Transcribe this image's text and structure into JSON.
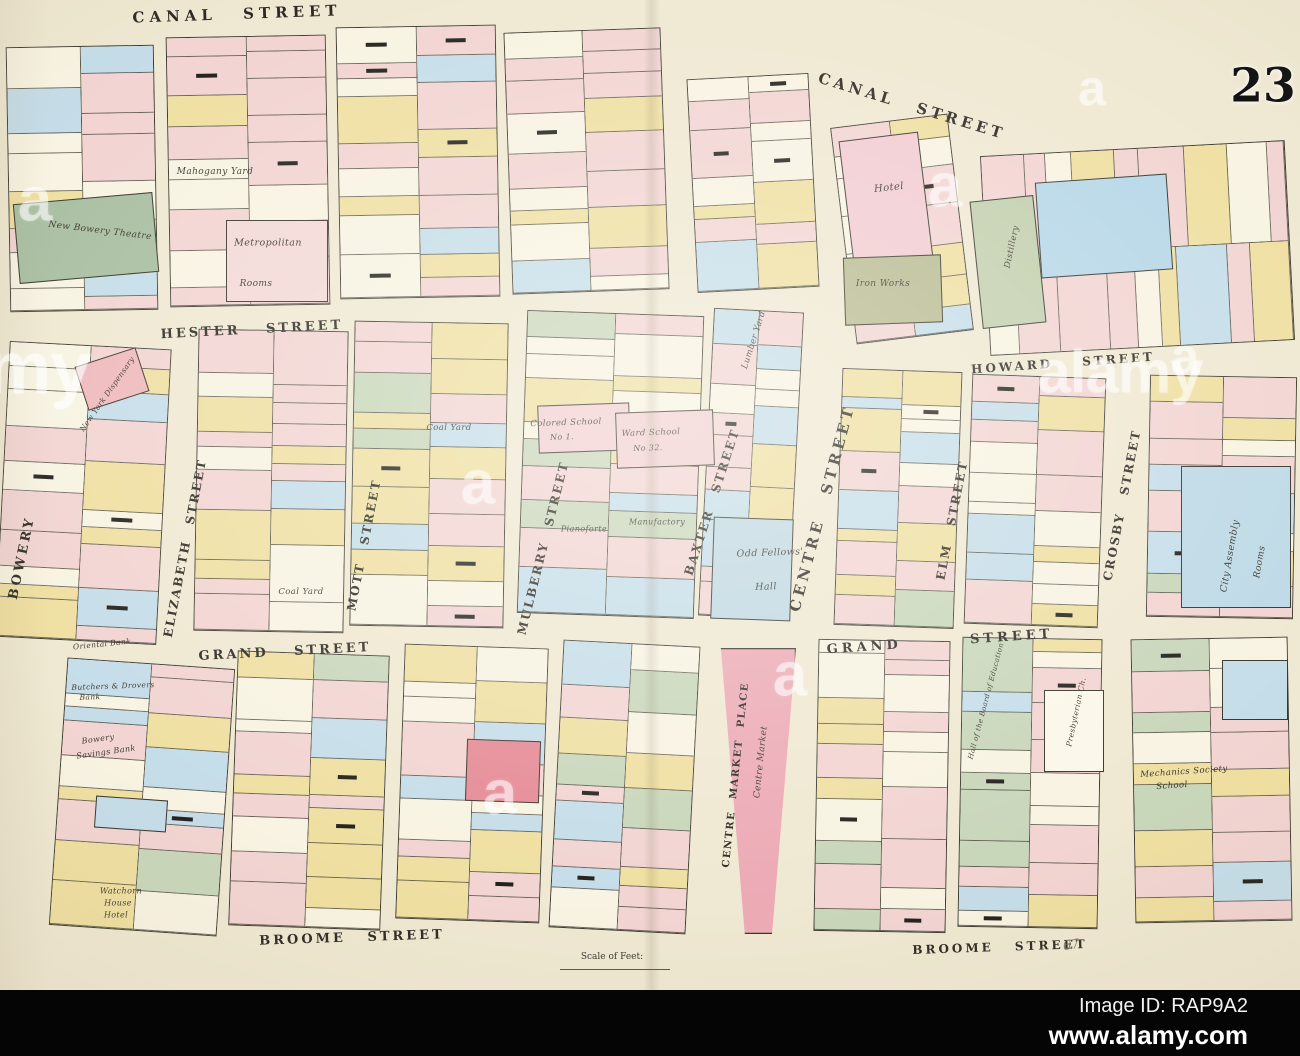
{
  "page": {
    "plate_number": "23"
  },
  "watermark": {
    "brand": "alamy",
    "tile_letter": "a",
    "image_id_label": "Image ID: RAP9A2",
    "url": "www.alamy.com",
    "tiles": [
      {
        "x": 35,
        "y": 200,
        "s": 62
      },
      {
        "x": 478,
        "y": 483,
        "s": 62
      },
      {
        "x": 500,
        "y": 793,
        "s": 62
      },
      {
        "x": 790,
        "y": 675,
        "s": 62
      },
      {
        "x": 945,
        "y": 186,
        "s": 62
      },
      {
        "x": 1092,
        "y": 88,
        "s": 50
      },
      {
        "x": 1185,
        "y": 357,
        "s": 52
      }
    ],
    "words": [
      {
        "x": -12,
        "y": 368,
        "s": 74
      },
      {
        "x": 1120,
        "y": 372,
        "s": 60
      }
    ]
  },
  "map": {
    "scale_label": "Scale of Feet:",
    "pencil_note": "67",
    "paper_color": "#efe8d2",
    "palette": {
      "pink": "#f2d4d2",
      "cream": "#f8f3e2",
      "yellow": "#efdfa1",
      "blue": "#c5dde9",
      "green": "#c8d6ba"
    },
    "street_labels": [
      {
        "text": "CANAL STREET",
        "x": 237,
        "y": 14,
        "r": -2,
        "s": 15,
        "ls": 5,
        "ws": 16
      },
      {
        "text": "CANAL STREET",
        "x": 912,
        "y": 106,
        "r": 17,
        "s": 15,
        "ls": 4,
        "ws": 14
      },
      {
        "text": "HESTER STREET",
        "x": 252,
        "y": 330,
        "r": -3,
        "s": 13,
        "ls": 3,
        "ws": 18
      },
      {
        "text": "HOWARD STREET",
        "x": 1063,
        "y": 363,
        "r": -4,
        "s": 12,
        "ls": 3,
        "ws": 22
      },
      {
        "text": "GRAND STREET",
        "x": 285,
        "y": 652,
        "r": -3,
        "s": 13,
        "ls": 3,
        "ws": 18
      },
      {
        "text": "GRAND STREET",
        "x": 940,
        "y": 642,
        "r": -4,
        "s": 13,
        "ls": 4,
        "ws": 60
      },
      {
        "text": "BROOME STREET",
        "x": 352,
        "y": 938,
        "r": -2,
        "s": 13,
        "ls": 3,
        "ws": 14
      },
      {
        "text": "BROOME STREET",
        "x": 1000,
        "y": 947,
        "r": -2,
        "s": 12,
        "ls": 3,
        "ws": 14
      },
      {
        "text": "BOWERY",
        "x": 22,
        "y": 558,
        "r": -78,
        "s": 13,
        "ls": 3,
        "ws": 8
      },
      {
        "text": "ELIZABETH STREET",
        "x": 185,
        "y": 548,
        "r": -79,
        "s": 12,
        "ls": 2,
        "ws": 10
      },
      {
        "text": "MOTT STREET",
        "x": 364,
        "y": 545,
        "r": -79,
        "s": 12,
        "ls": 2,
        "ws": 12
      },
      {
        "text": "MULBERRY STREET",
        "x": 543,
        "y": 548,
        "r": -76,
        "s": 12,
        "ls": 2,
        "ws": 10
      },
      {
        "text": "BAXTER STREET",
        "x": 712,
        "y": 502,
        "r": -72,
        "s": 12,
        "ls": 2,
        "ws": 12
      },
      {
        "text": "CENTRE STREET",
        "x": 822,
        "y": 508,
        "r": -75,
        "s": 15,
        "ls": 4,
        "ws": 16
      },
      {
        "text": "ELM STREET",
        "x": 952,
        "y": 520,
        "r": -79,
        "s": 12,
        "ls": 2,
        "ws": 12
      },
      {
        "text": "CROSBY STREET",
        "x": 1122,
        "y": 505,
        "r": -79,
        "s": 12,
        "ls": 2,
        "ws": 12
      },
      {
        "text": "CENTRE MARKET PLACE",
        "x": 736,
        "y": 775,
        "r": -84,
        "s": 10,
        "ls": 1.5,
        "ws": 7
      }
    ],
    "building_labels": [
      {
        "text": "Mahogany Yard",
        "x": 215,
        "y": 172,
        "r": 0,
        "s": 9
      },
      {
        "text": "Metropolitan",
        "x": 268,
        "y": 243,
        "r": 0,
        "s": 9.5
      },
      {
        "text": "Rooms",
        "x": 256,
        "y": 284,
        "r": 0,
        "s": 9
      },
      {
        "text": "New Bowery Theatre",
        "x": 100,
        "y": 231,
        "r": 7,
        "s": 9
      },
      {
        "text": "New York Dispensary",
        "x": 107,
        "y": 394,
        "r": -55,
        "s": 7.5
      },
      {
        "text": "Hotel",
        "x": 889,
        "y": 188,
        "r": -6,
        "s": 10
      },
      {
        "text": "Iron Works",
        "x": 883,
        "y": 284,
        "r": 0,
        "s": 9
      },
      {
        "text": "Distillery",
        "x": 1012,
        "y": 247,
        "r": -78,
        "s": 8.5
      },
      {
        "text": "Coal Yard",
        "x": 449,
        "y": 428,
        "r": 0,
        "s": 8.5
      },
      {
        "text": "Colored School",
        "x": 566,
        "y": 423,
        "r": -2,
        "s": 8.5
      },
      {
        "text": "No 1.",
        "x": 562,
        "y": 437,
        "r": -2,
        "s": 8
      },
      {
        "text": "Ward School",
        "x": 651,
        "y": 433,
        "r": -2,
        "s": 8.5
      },
      {
        "text": "No 32.",
        "x": 648,
        "y": 448,
        "r": -2,
        "s": 8
      },
      {
        "text": "Lumber Yard",
        "x": 754,
        "y": 340,
        "r": -72,
        "s": 8.5
      },
      {
        "text": "Pianoforte",
        "x": 584,
        "y": 529,
        "r": 0,
        "s": 8
      },
      {
        "text": "Manufactory",
        "x": 657,
        "y": 522,
        "r": 0,
        "s": 8
      },
      {
        "text": "Odd Fellows'",
        "x": 770,
        "y": 553,
        "r": -2,
        "s": 9.5
      },
      {
        "text": "Hall",
        "x": 766,
        "y": 587,
        "r": -2,
        "s": 9.5
      },
      {
        "text": "City Assembly",
        "x": 1230,
        "y": 556,
        "r": -80,
        "s": 9.5
      },
      {
        "text": "Rooms",
        "x": 1260,
        "y": 562,
        "r": -80,
        "s": 9
      },
      {
        "text": "Coal Yard",
        "x": 301,
        "y": 592,
        "r": 0,
        "s": 8.5
      },
      {
        "text": "Oriental Bank",
        "x": 102,
        "y": 644,
        "r": -6,
        "s": 7.5
      },
      {
        "text": "Butchers & Drovers",
        "x": 113,
        "y": 686,
        "r": -2,
        "s": 7.5
      },
      {
        "text": "Bank",
        "x": 90,
        "y": 697,
        "r": -2,
        "s": 7.5
      },
      {
        "text": "Bowery",
        "x": 98,
        "y": 739,
        "r": -8,
        "s": 8
      },
      {
        "text": "Savings Bank",
        "x": 106,
        "y": 752,
        "r": -8,
        "s": 8
      },
      {
        "text": "Watchorn",
        "x": 121,
        "y": 891,
        "r": 0,
        "s": 8
      },
      {
        "text": "House",
        "x": 118,
        "y": 903,
        "r": 0,
        "s": 8
      },
      {
        "text": "Hotel",
        "x": 116,
        "y": 915,
        "r": 0,
        "s": 8
      },
      {
        "text": "Hall of the Board of Education",
        "x": 986,
        "y": 701,
        "r": -75,
        "s": 7
      },
      {
        "text": "Presbyterian Ch.",
        "x": 1076,
        "y": 712,
        "r": -78,
        "s": 7.5
      },
      {
        "text": "Centre Market",
        "x": 761,
        "y": 762,
        "r": -84,
        "s": 9
      },
      {
        "text": "Mechanics Society",
        "x": 1184,
        "y": 772,
        "r": -4,
        "s": 8.5
      },
      {
        "text": "School",
        "x": 1172,
        "y": 786,
        "r": -4,
        "s": 8.5
      }
    ],
    "blocks": [
      {
        "x": 8,
        "y": 46,
        "w": 148,
        "h": 265,
        "r": -1,
        "dir": "v",
        "n": 8,
        "seed": 11
      },
      {
        "x": 168,
        "y": 36,
        "w": 160,
        "h": 270,
        "r": -1,
        "dir": "v",
        "n": 9,
        "seed": 12
      },
      {
        "x": 338,
        "y": 26,
        "w": 160,
        "h": 272,
        "r": -1,
        "dir": "v",
        "n": 9,
        "seed": 13
      },
      {
        "x": 508,
        "y": 30,
        "w": 157,
        "h": 262,
        "r": -2,
        "dir": "v",
        "n": 9,
        "seed": 14
      },
      {
        "x": 692,
        "y": 76,
        "w": 122,
        "h": 214,
        "r": -3,
        "dir": "v",
        "n": 7,
        "seed": 15
      },
      {
        "x": 843,
        "y": 120,
        "w": 118,
        "h": 218,
        "r": -7,
        "dir": "v",
        "n": 7,
        "seed": 16
      },
      {
        "x": 985,
        "y": 148,
        "w": 305,
        "h": 200,
        "r": -3,
        "dir": "h",
        "n": 9,
        "seed": 17
      },
      {
        "x": 2,
        "y": 345,
        "w": 162,
        "h": 296,
        "r": 3,
        "dir": "v",
        "n": 10,
        "seed": 21
      },
      {
        "x": 196,
        "y": 330,
        "w": 150,
        "h": 302,
        "r": 1,
        "dir": "v",
        "n": 10,
        "seed": 22
      },
      {
        "x": 352,
        "y": 322,
        "w": 154,
        "h": 305,
        "r": 1,
        "dir": "v",
        "n": 10,
        "seed": 23
      },
      {
        "x": 522,
        "y": 313,
        "w": 177,
        "h": 303,
        "r": 2,
        "dir": "v",
        "n": 10,
        "seed": 24
      },
      {
        "x": 706,
        "y": 310,
        "w": 90,
        "h": 308,
        "r": 3,
        "dir": "v",
        "n": 10,
        "seed": 25
      },
      {
        "x": 838,
        "y": 370,
        "w": 120,
        "h": 257,
        "r": 2,
        "dir": "v",
        "n": 9,
        "seed": 26
      },
      {
        "x": 968,
        "y": 376,
        "w": 134,
        "h": 250,
        "r": 2,
        "dir": "v",
        "n": 9,
        "seed": 27
      },
      {
        "x": 1148,
        "y": 376,
        "w": 147,
        "h": 242,
        "r": 1,
        "dir": "v",
        "n": 8,
        "seed": 28
      },
      {
        "x": 58,
        "y": 663,
        "w": 168,
        "h": 268,
        "r": 4,
        "dir": "v",
        "n": 9,
        "seed": 31
      },
      {
        "x": 233,
        "y": 653,
        "w": 152,
        "h": 275,
        "r": 2,
        "dir": "v",
        "n": 9,
        "seed": 32
      },
      {
        "x": 400,
        "y": 646,
        "w": 144,
        "h": 275,
        "r": 2,
        "dir": "v",
        "n": 9,
        "seed": 33
      },
      {
        "x": 556,
        "y": 643,
        "w": 137,
        "h": 288,
        "r": 3,
        "dir": "v",
        "n": 9,
        "seed": 34
      },
      {
        "x": 816,
        "y": 640,
        "w": 132,
        "h": 292,
        "r": 1,
        "dir": "v",
        "n": 10,
        "seed": 35
      },
      {
        "x": 960,
        "y": 638,
        "w": 140,
        "h": 290,
        "r": 1,
        "dir": "v",
        "n": 10,
        "seed": 36
      },
      {
        "x": 1133,
        "y": 638,
        "w": 157,
        "h": 284,
        "r": -1,
        "dir": "v",
        "n": 9,
        "seed": 37
      }
    ],
    "special_buildings": [
      {
        "name": "new-bowery-theatre",
        "x": 16,
        "y": 198,
        "w": 140,
        "h": 80,
        "r": -5,
        "color": "#a9bfa2"
      },
      {
        "name": "metropolitan-rooms",
        "x": 226,
        "y": 220,
        "w": 102,
        "h": 82,
        "r": 0,
        "color": "#f3d9d7"
      },
      {
        "name": "dispensary",
        "x": 80,
        "y": 356,
        "w": 64,
        "h": 46,
        "r": -18,
        "color": "#efb9bd"
      },
      {
        "name": "hotel",
        "x": 846,
        "y": 136,
        "w": 80,
        "h": 128,
        "r": -7,
        "color": "#f2ccd2"
      },
      {
        "name": "iron-works",
        "x": 844,
        "y": 256,
        "w": 98,
        "h": 68,
        "r": -2,
        "color": "#b7ba90"
      },
      {
        "name": "distillery",
        "x": 976,
        "y": 198,
        "w": 64,
        "h": 128,
        "r": -6,
        "color": "#c2cfae"
      },
      {
        "name": "canal-blue-building",
        "x": 1038,
        "y": 178,
        "w": 132,
        "h": 96,
        "r": -4,
        "color": "#b7d7e8"
      },
      {
        "name": "colored-school",
        "x": 538,
        "y": 404,
        "w": 92,
        "h": 48,
        "r": -2,
        "color": "#f1cfd0"
      },
      {
        "name": "ward-school",
        "x": 616,
        "y": 411,
        "w": 98,
        "h": 56,
        "r": -2,
        "color": "#f1cfd0"
      },
      {
        "name": "odd-fellows-hall",
        "x": 712,
        "y": 518,
        "w": 80,
        "h": 102,
        "r": 2,
        "color": "#c0d8e2"
      },
      {
        "name": "city-assembly-rooms",
        "x": 1181,
        "y": 466,
        "w": 110,
        "h": 142,
        "r": 0,
        "color": "#bdd9e6"
      },
      {
        "name": "red-lots",
        "x": 466,
        "y": 740,
        "w": 74,
        "h": 62,
        "r": 2,
        "color": "#e58a96"
      },
      {
        "name": "centre-market",
        "x": 716,
        "y": 648,
        "w": 80,
        "h": 286,
        "r": 0,
        "color": "#ecaab5",
        "clip": "polygon(6% 0, 100% 0, 70% 100%, 36% 100%)"
      },
      {
        "name": "presbyterian-church",
        "x": 1044,
        "y": 690,
        "w": 60,
        "h": 82,
        "r": 0,
        "color": "#fbf7ea"
      },
      {
        "name": "crosby-blue-lot",
        "x": 1222,
        "y": 660,
        "w": 66,
        "h": 60,
        "r": 0,
        "color": "#c5dde9"
      },
      {
        "name": "bowery-blue-lot",
        "x": 95,
        "y": 798,
        "w": 72,
        "h": 32,
        "r": 4,
        "color": "#c5dde9"
      }
    ]
  }
}
